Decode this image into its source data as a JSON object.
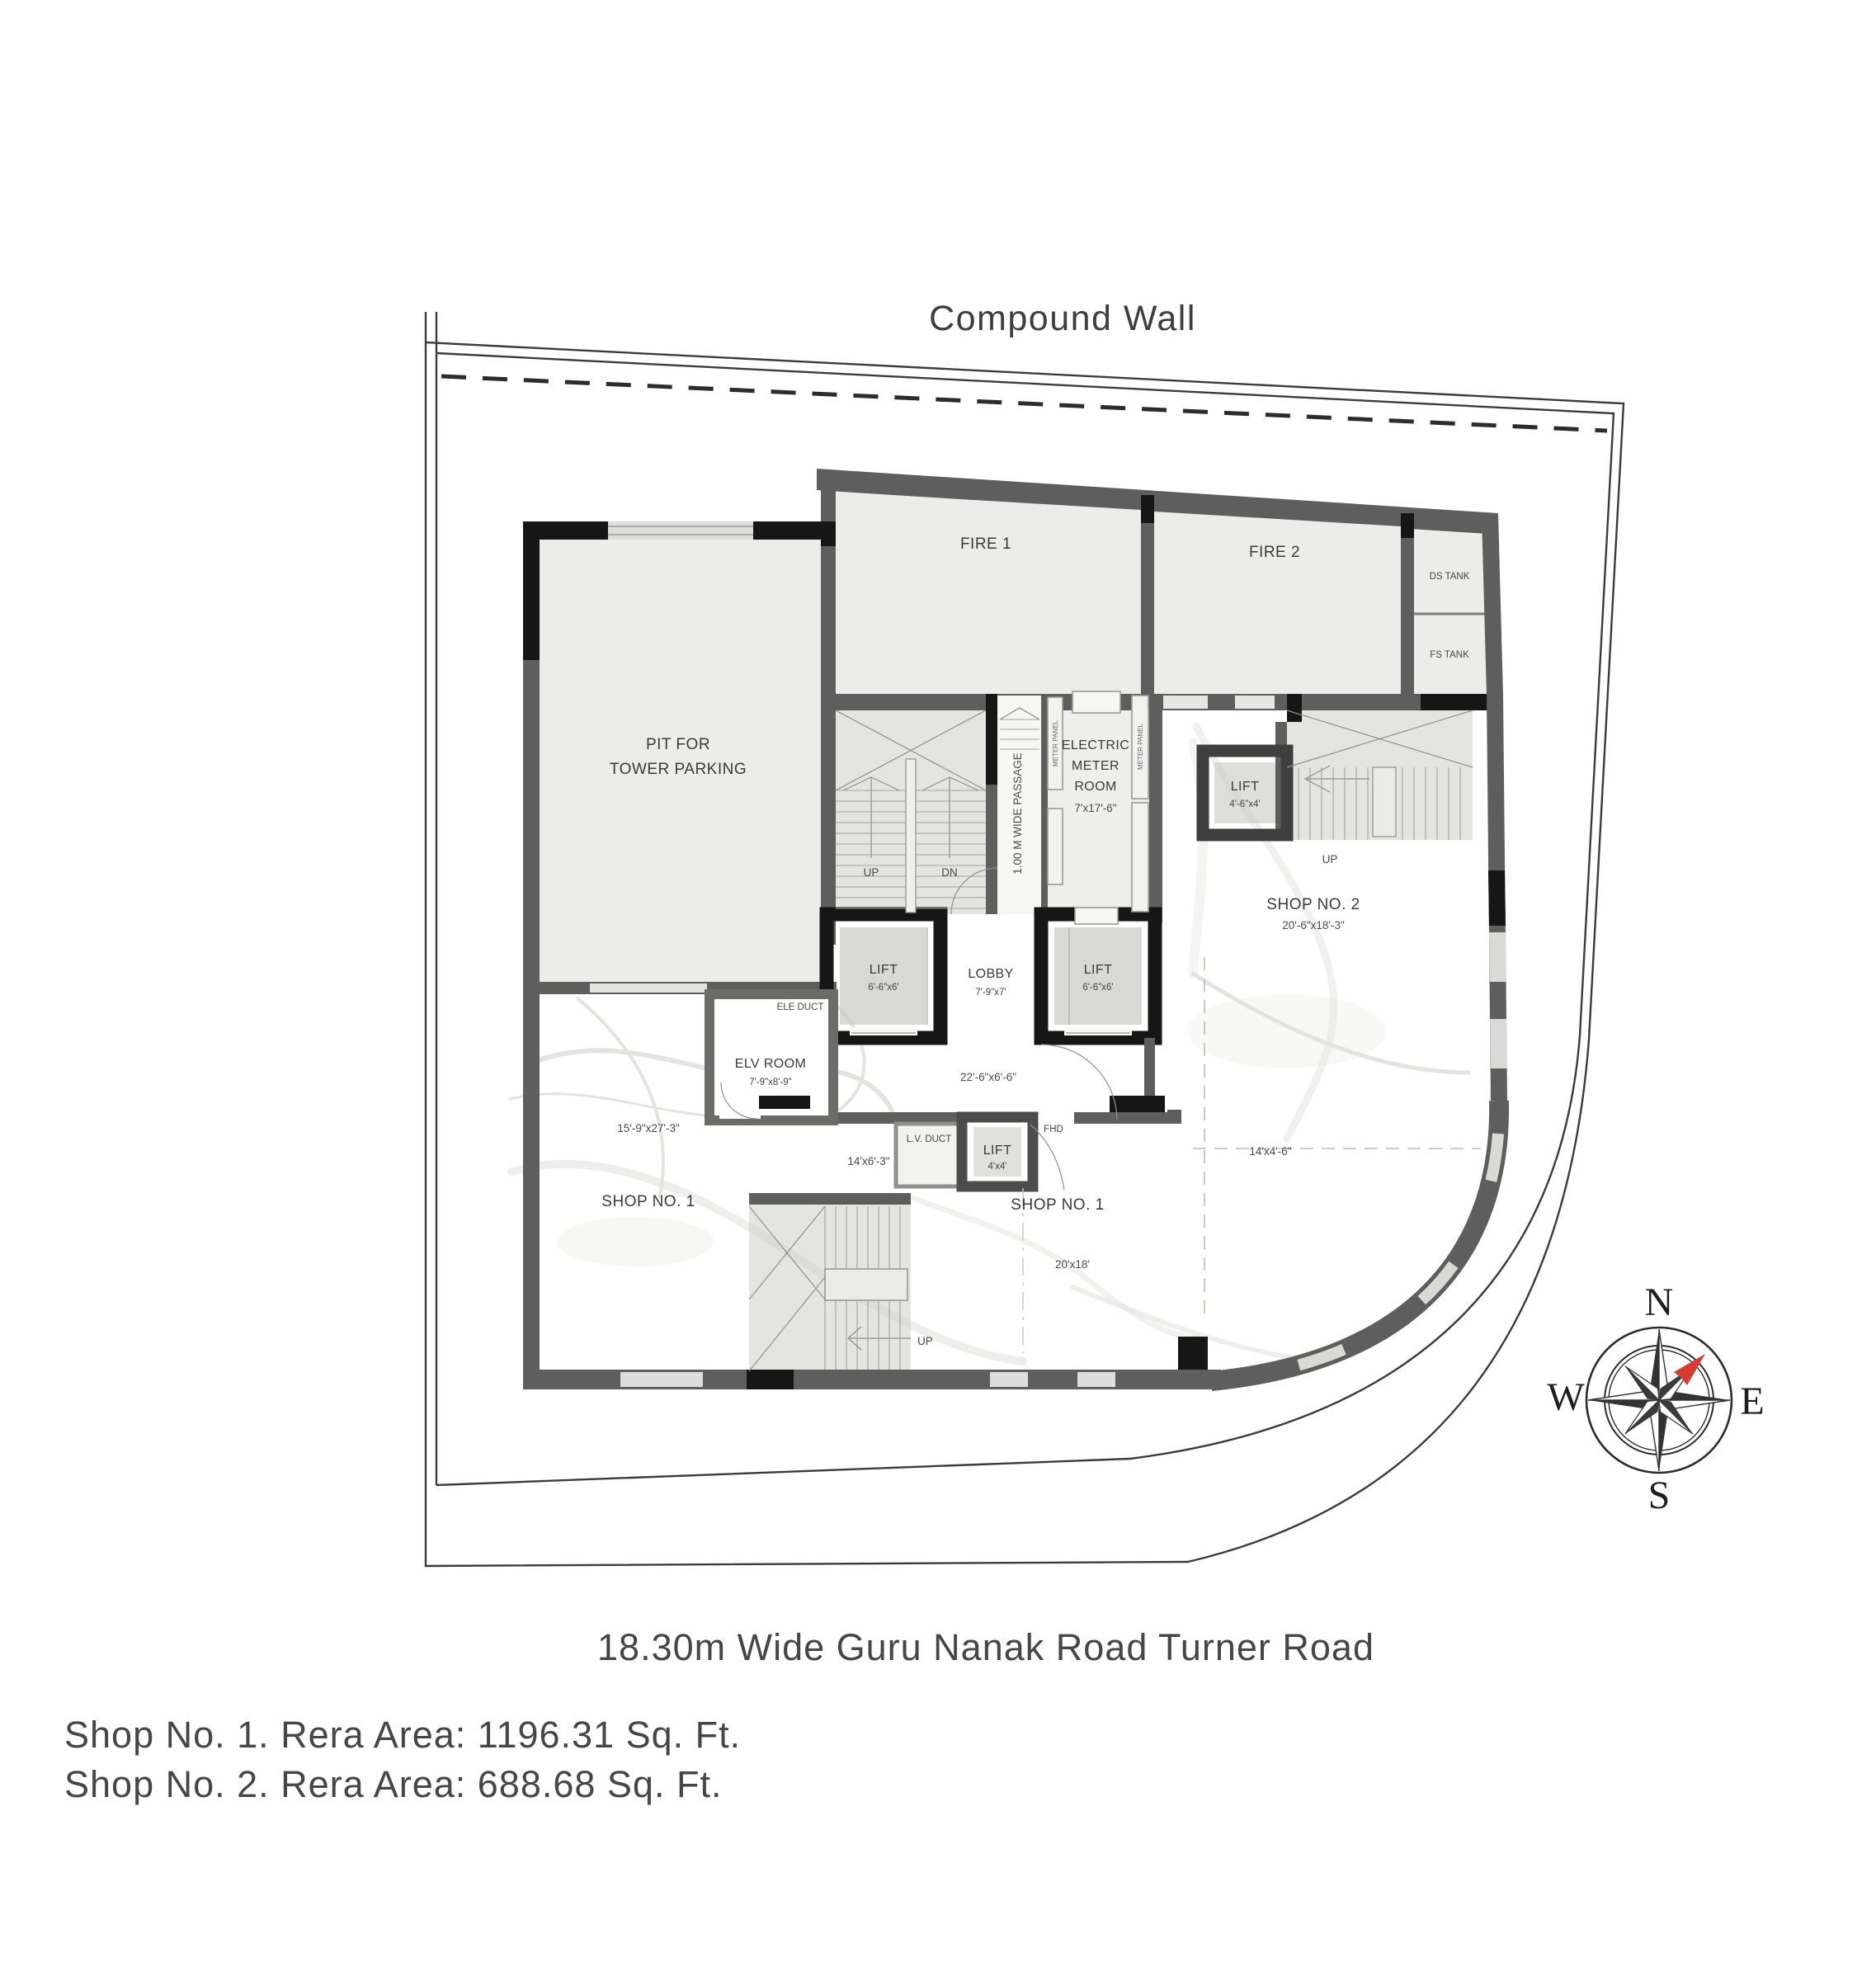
{
  "colors": {
    "wall_gray": "#5e5e5e",
    "wall_black": "#161616",
    "room_fill": "#ececea",
    "stair_fill": "#e4e4e1",
    "compass_red": "#d63a31",
    "text": "#3a3a3a"
  },
  "plan": {
    "compound_wall": "Compound Wall",
    "pit_line1": "PIT FOR",
    "pit_line2": "TOWER PARKING",
    "fire1": "FIRE 1",
    "fire2": "FIRE 2",
    "ds_tank": "DS TANK",
    "fs_tank": "FS TANK",
    "emr_1": "ELECTRIC",
    "emr_2": "METER",
    "emr_3": "ROOM",
    "emr_dim": "7'x17'-6\"",
    "passage": "1.00 M WIDE PASSAGE",
    "up": "UP",
    "dn": "DN",
    "lift": "LIFT",
    "lift_dim_66": "6'-6\"x6'",
    "lobby": "LOBBY",
    "lobby_dim": "7'-9\"x7'",
    "lift_dim_464": "4'-6\"x4'",
    "lift_dim_44": "4'x4'",
    "shop2": "SHOP NO. 2",
    "shop2_dim": "20'-6\"x18'-3\"",
    "shop2_dim2": "14'x4'-6\"",
    "ele_duct": "ELE DUCT",
    "elv_room": "ELV ROOM",
    "elv_dim": "7'-9\"x8'-9\"",
    "shop1": "SHOP NO. 1",
    "shop1_dim": "15'-9\"x27'-3\"",
    "dim_14_63": "14'x6'-3\"",
    "corridor_dim": "22'-6\"x6'-6\"",
    "lv_duct": "L.V. DUCT",
    "fhd": "FHD",
    "shop1_main_dim": "20'x18'",
    "meter_panel": "METER PANEL"
  },
  "compass": {
    "n": "N",
    "e": "E",
    "s": "S",
    "w": "W"
  },
  "footer": {
    "road": "18.30m Wide Guru Nanak Road Turner Road",
    "shop1_area": "Shop No. 1. Rera Area: 1196.31 Sq. Ft.",
    "shop2_area": "Shop No. 2. Rera Area: 688.68 Sq. Ft."
  }
}
